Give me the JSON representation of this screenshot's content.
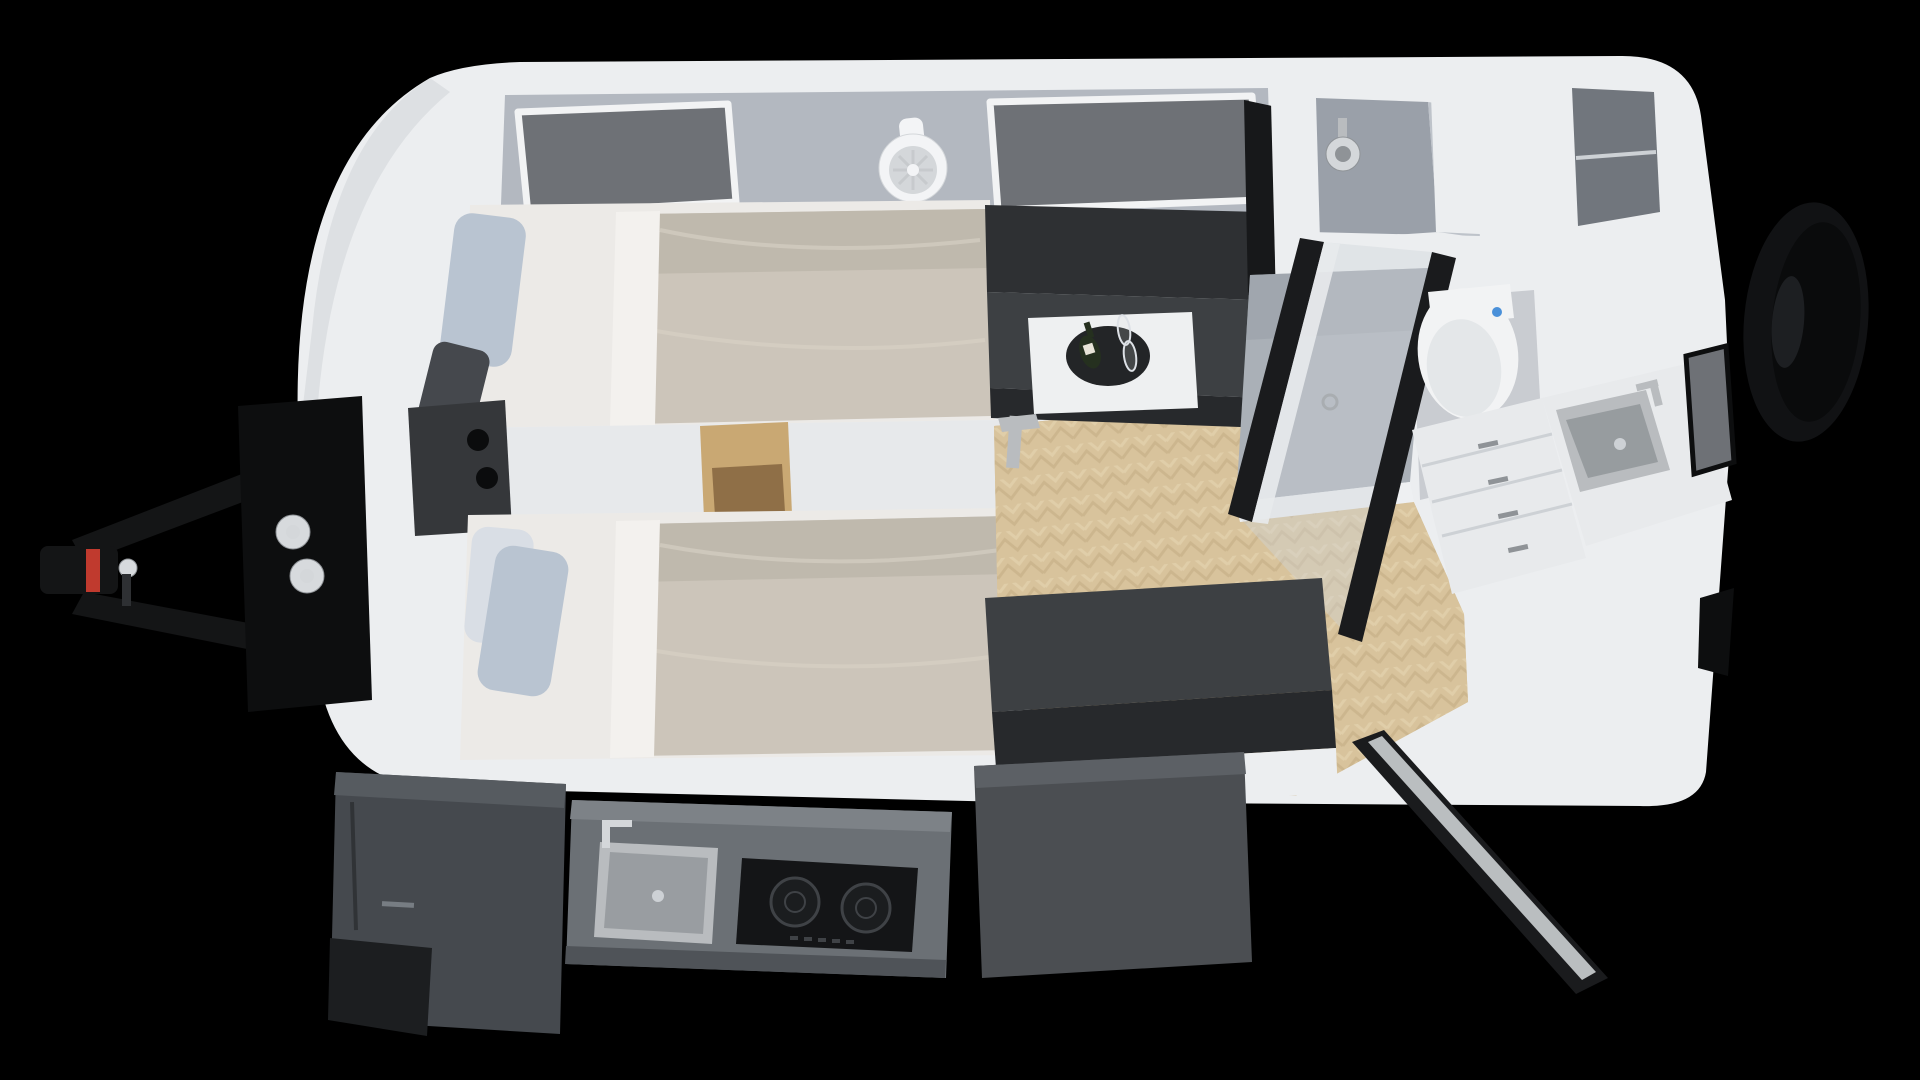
{
  "labels": {
    "scene": "caravan-interior-top-view-render",
    "shell": "caravan body shell",
    "hitch": "tow hitch drawbar",
    "coupler": "hitch coupler",
    "front_box": "front storage box",
    "gas_bottles": "gas bottles",
    "spare_wheel": "spare wheel",
    "front_wall": "front wall",
    "window_left": "front window left",
    "window_right": "front window right",
    "wall_fan": "wall mounted fan",
    "bed_upper": "single bed upper",
    "bed_lower": "single bed lower",
    "pillow": "pillow",
    "console": "center console between beds",
    "cup_holders": "cup holders",
    "cubby": "wooden storage cubby",
    "dinette_bench": "dinette bench",
    "dinette_table": "dinette table",
    "tray": "serving tray",
    "bottle": "wine bottle",
    "glasses": "wine glasses",
    "tv": "wall mounted tv",
    "shower": "shower cabin",
    "shower_head": "shower head",
    "shower_tray": "shower tray",
    "shower_door": "glass shower door",
    "toilet": "toilet",
    "wall_cabinet": "overhead wall cabinet",
    "drawers": "drawer cabinet",
    "basin": "washbasin",
    "faucet": "faucet",
    "side_window": "side wall window",
    "wood_floor": "herringbone wood floor",
    "sofa": "lounge sofa",
    "entry_door": "entry door open",
    "outdoor_table": "slide-out table",
    "kitchen": "pull-out outdoor kitchen",
    "kitchen_sink": "kitchen sink",
    "cooktop": "induction cooktop",
    "fridge": "slide-out storage fridge box"
  },
  "palette": {
    "bg": "#000000",
    "shellWhite": "#eceef0",
    "shellEdge": "#d7dadd",
    "wallGray": "#b3b8c0",
    "wallDark": "#9aa0a9",
    "windowGray": "#6e7176",
    "windowFrame": "#f2f3f4",
    "fanWhite": "#f3f4f6",
    "fanRing": "#d4d7da",
    "fanBlade": "#c7cacd",
    "sheetWhite": "#eceae7",
    "sheetFold": "#f3f1ee",
    "duvetBeige": "#ccc5ba",
    "duvetShade": "#b9b2a6",
    "duvetLight": "#d9d2c7",
    "pillowBlue": "#b9c4d1",
    "pillowPale": "#d9dee5",
    "pillowDark": "#45484d",
    "consoleWhite": "#e7e9eb",
    "counterDark": "#35373a",
    "holeBlack": "#0b0c0d",
    "woodCubby": "#c9a873",
    "woodCubbyDark": "#8f6f47",
    "benchDark": "#2e3033",
    "benchCharcoal": "#3d4043",
    "benchFront": "#27292c",
    "tableWhite": "#eef0f1",
    "trayBlack": "#232527",
    "bottleGreen": "#25301f",
    "bottleLabel": "#e8e4d8",
    "glassStroke": "#dde1e6",
    "steel": "#b9bcbf",
    "steelDark": "#8f9397",
    "tvBlack": "#17181a",
    "tvRed": "#b8372b",
    "tvGray": "#5a5e63",
    "bathWall": "#9aa0a9",
    "bathFloor": "#c9ccd1",
    "trayGray": "#aab0b7",
    "trayShade": "#9aa0a8",
    "rimWhite": "#eef0f2",
    "cabinetInner": "#71767d",
    "toiletWhite": "#f2f3f4",
    "toiletSeat": "#e4e7e9",
    "blueDot": "#4a90d9",
    "cabinetWhite": "#e8eaec",
    "drawerLine": "#cdd1d5",
    "doorBlack": "#1a1b1d",
    "glassPane": "#cfd4da",
    "woodFloor": "#d8c39c",
    "woodDark": "#c3ab82",
    "woodLight": "#e6d5b3",
    "slideGray": "#6b7075",
    "slideLip": "#7d8287",
    "slideFront": "#4f5358",
    "cooktopBlack": "#141517",
    "burnerRing": "#3f4246",
    "burnerFill": "#1b1d1f",
    "fridgeGray": "#45494e",
    "fridgeTop": "#565b60",
    "fridgeDark": "#1c1e20",
    "logoGray": "#9aa0a6",
    "tableSlide": "#4b4e52",
    "tableSlideTop": "#5c6065",
    "hitchBlack": "#141516",
    "red": "#c03a2e",
    "knobWhite": "#d7dadd",
    "tire": "#111214",
    "tireDark": "#0a0b0c",
    "rimDark": "#1d1f22",
    "trimBlack": "#0d0e0f"
  }
}
